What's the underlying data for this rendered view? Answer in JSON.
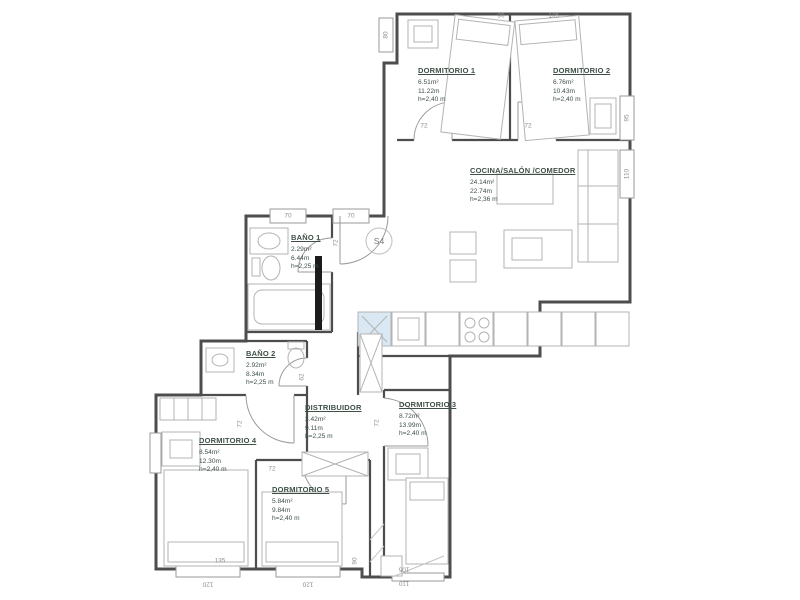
{
  "plan": {
    "stair_label": "S4",
    "colors": {
      "wall": "#4d4d4d",
      "furniture": "#b3b3b3",
      "room_text": "#3f5046",
      "dim_text": "#8f8f8f",
      "sink_blue": "#d9e8f2",
      "radiator_black": "#1c1c1c",
      "background": "#ffffff"
    },
    "rooms": [
      {
        "id": "dormitorio-1",
        "name": "DORMITORIO 1",
        "area": "6.51m²",
        "perimeter": "11.22m",
        "height": "h=2,40 m",
        "x": 418,
        "y": 66
      },
      {
        "id": "dormitorio-2",
        "name": "DORMITORIO 2",
        "area": "6.76m²",
        "perimeter": "10.43m",
        "height": "h=2,40 m",
        "x": 553,
        "y": 66
      },
      {
        "id": "cocina-salon-comedor",
        "name": "COCINA/SALÓN /COMEDOR",
        "area": "24.14m²",
        "perimeter": "22.74m",
        "height": "h=2,36 m",
        "x": 470,
        "y": 166
      },
      {
        "id": "bano-1",
        "name": "BAÑO 1",
        "area": "2.29m²",
        "perimeter": "6.44m",
        "height": "h=2,25 m",
        "x": 291,
        "y": 233
      },
      {
        "id": "bano-2",
        "name": "BAÑO 2",
        "area": "2.92m²",
        "perimeter": "8.34m",
        "height": "h=2,25 m",
        "x": 246,
        "y": 349
      },
      {
        "id": "distribuidor",
        "name": "DISTRIBUIDOR",
        "area": "3.42m²",
        "perimeter": "9.11m",
        "height": "h=2,25 m",
        "x": 305,
        "y": 403
      },
      {
        "id": "dormitorio-3",
        "name": "DORMITORIO 3",
        "area": "8.72m²",
        "perimeter": "13.99m",
        "height": "h=2,40 m",
        "x": 399,
        "y": 400
      },
      {
        "id": "dormitorio-4",
        "name": "DORMITORIO 4",
        "area": "8.54m²",
        "perimeter": "12.30m",
        "height": "h=2,40 m",
        "x": 199,
        "y": 436
      },
      {
        "id": "dormitorio-5",
        "name": "DORMITORIO 5",
        "area": "5.84m²",
        "perimeter": "9.84m",
        "height": "h=2,40 m",
        "x": 272,
        "y": 485
      }
    ],
    "dimensions": [
      {
        "text": "90",
        "x": 501,
        "y": 16,
        "rot": 0
      },
      {
        "text": "105",
        "x": 554,
        "y": 16,
        "rot": 0
      },
      {
        "text": "80",
        "x": 386,
        "y": 35,
        "rot": -90
      },
      {
        "text": "95",
        "x": 627,
        "y": 118,
        "rot": -90
      },
      {
        "text": "110",
        "x": 627,
        "y": 174,
        "rot": -90
      },
      {
        "text": "70",
        "x": 288,
        "y": 216,
        "rot": 0
      },
      {
        "text": "70",
        "x": 351,
        "y": 216,
        "rot": 0
      },
      {
        "text": "72",
        "x": 424,
        "y": 126,
        "rot": 0
      },
      {
        "text": "72",
        "x": 528,
        "y": 126,
        "rot": 0
      },
      {
        "text": "72",
        "x": 336,
        "y": 243,
        "rot": -90
      },
      {
        "text": "62",
        "x": 302,
        "y": 377,
        "rot": -90
      },
      {
        "text": "72",
        "x": 240,
        "y": 424,
        "rot": -90
      },
      {
        "text": "72",
        "x": 377,
        "y": 423,
        "rot": -90
      },
      {
        "text": "72",
        "x": 272,
        "y": 469,
        "rot": 0
      },
      {
        "text": "135",
        "x": 220,
        "y": 561,
        "rot": 0
      },
      {
        "text": "120",
        "x": 208,
        "y": 584,
        "rot": 180
      },
      {
        "text": "120",
        "x": 308,
        "y": 584,
        "rot": 180
      },
      {
        "text": "90",
        "x": 355,
        "y": 561,
        "rot": -90
      },
      {
        "text": "105",
        "x": 404,
        "y": 569,
        "rot": 180
      },
      {
        "text": "110",
        "x": 404,
        "y": 583,
        "rot": 180
      }
    ],
    "stair": {
      "x": 379,
      "y": 241
    }
  }
}
